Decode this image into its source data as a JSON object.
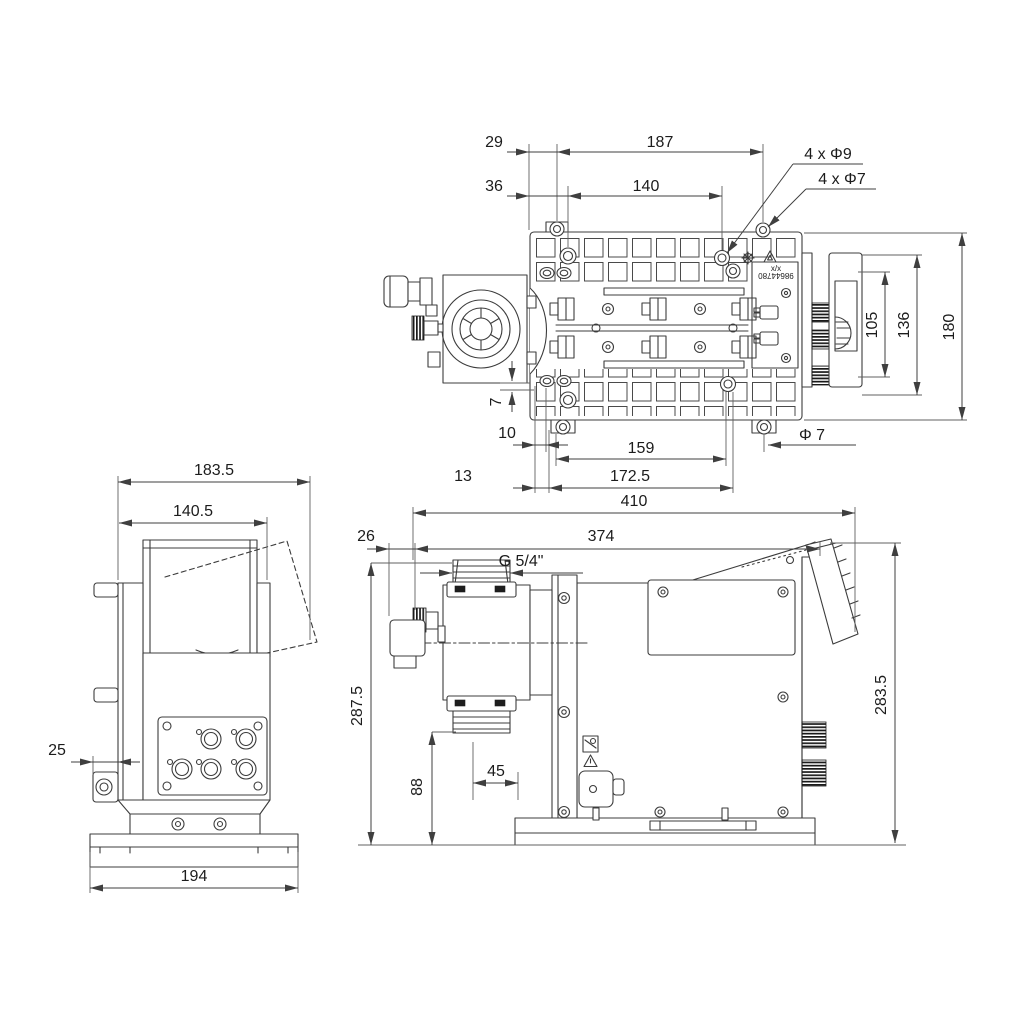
{
  "top": {
    "d29": "29",
    "d187": "187",
    "d36": "36",
    "d140": "140",
    "holes9": "4 x Φ9",
    "holes7": "4 x Φ7",
    "d105": "105",
    "d136": "136",
    "d180": "180",
    "d7": "7",
    "d10": "10",
    "d159": "159",
    "phi7": "Φ 7",
    "d13": "13",
    "d172_5": "172.5",
    "plate_mark": "x/x",
    "plate_code": "98644780"
  },
  "front": {
    "d183_5": "183.5",
    "d140_5": "140.5",
    "d25": "25",
    "d194": "194"
  },
  "side": {
    "d410": "410",
    "d26": "26",
    "d374": "374",
    "thread": "G 5/4\"",
    "d287_5": "287.5",
    "d88": "88",
    "d45": "45",
    "d283_5": "283.5"
  },
  "colors": {
    "line": "#3c3c3c",
    "dim": "#3f3f3f",
    "text": "#1c1c1c",
    "background": "#ffffff"
  }
}
